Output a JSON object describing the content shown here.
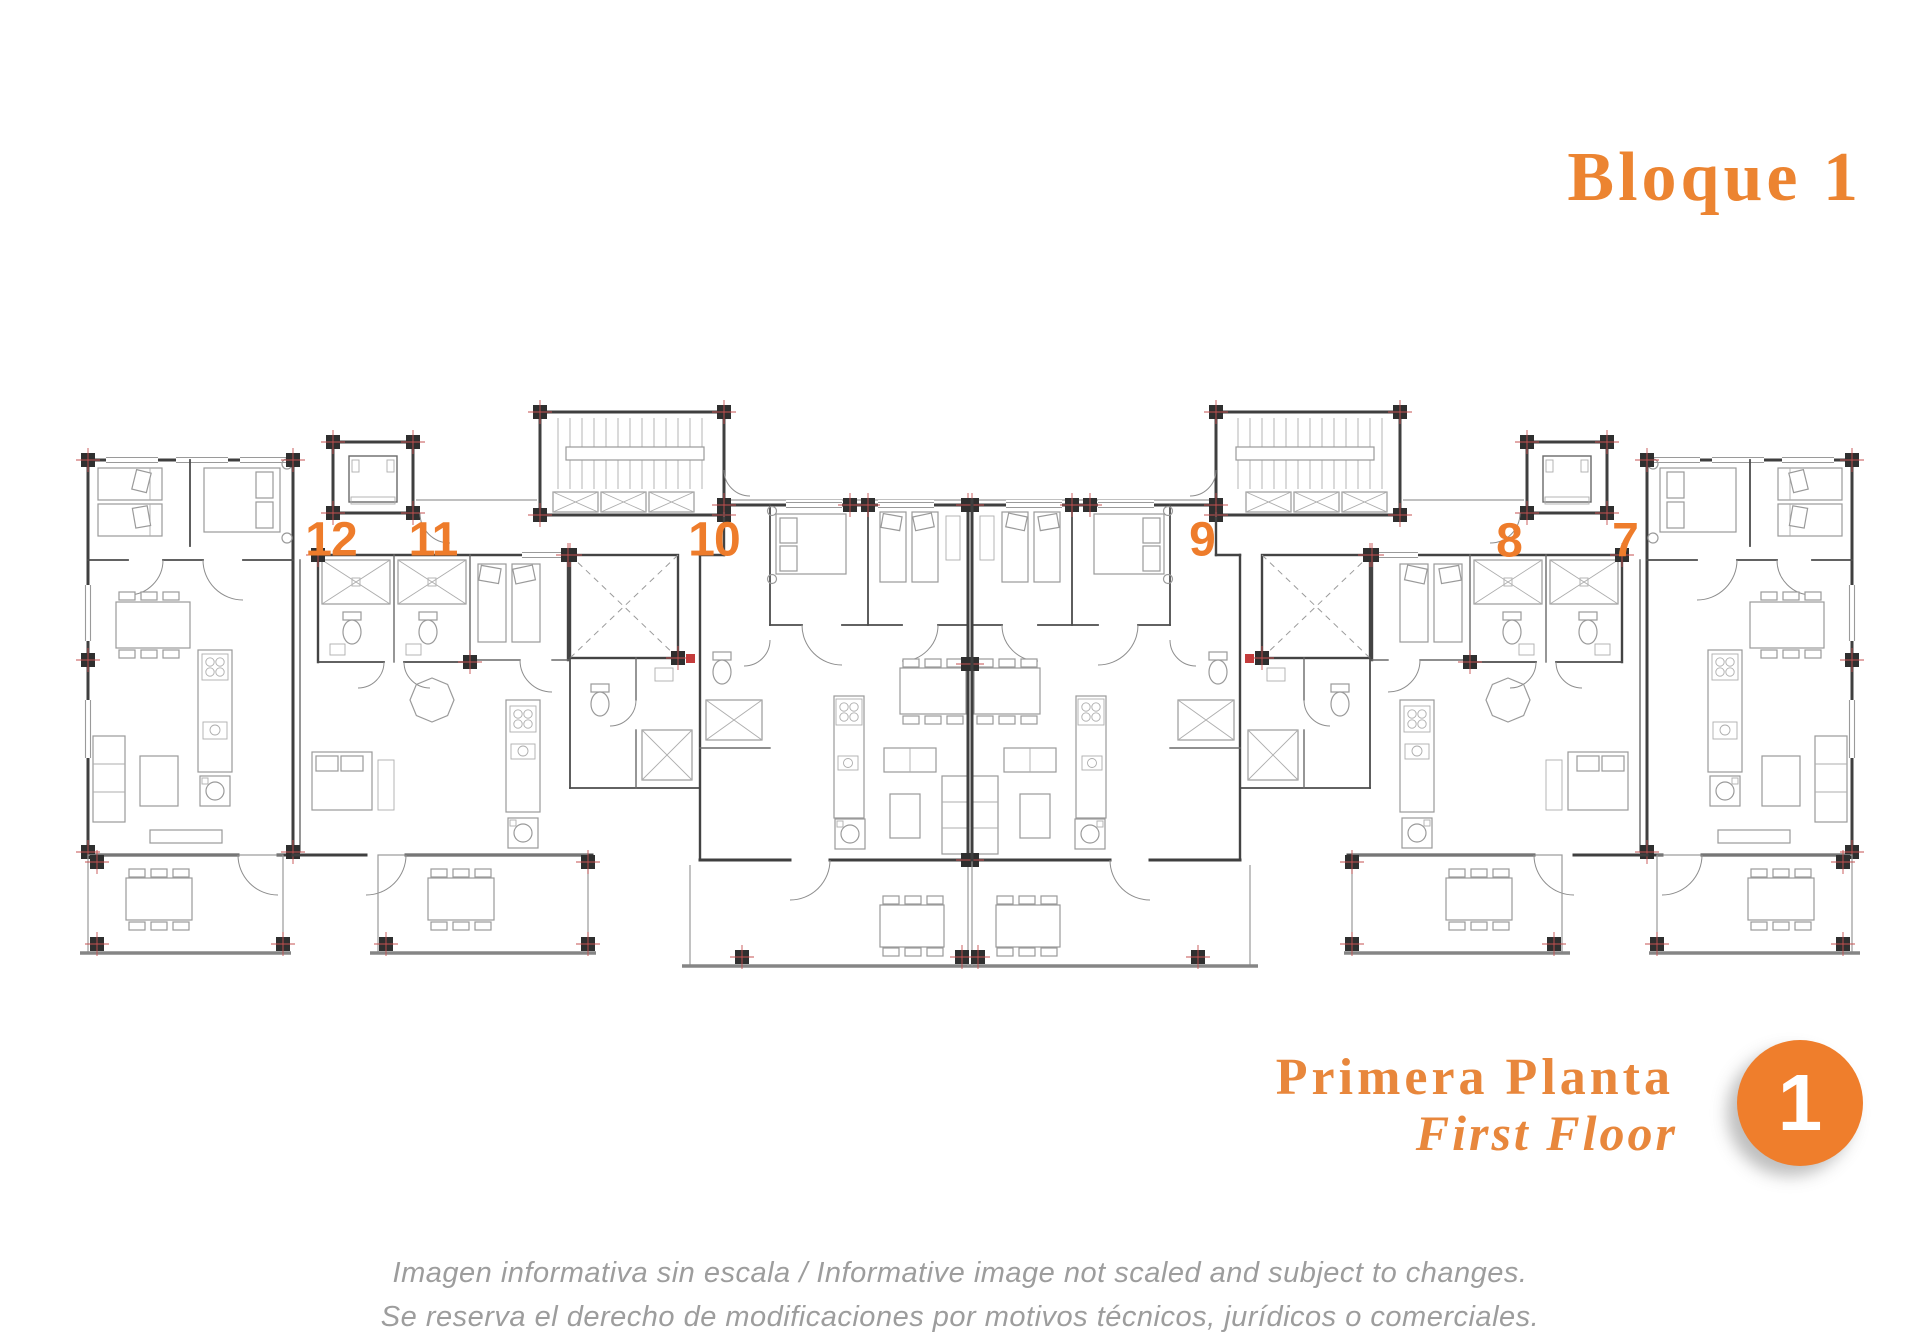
{
  "header": {
    "block_title": "Bloque 1"
  },
  "plan": {
    "units": [
      {
        "id": "unit-12",
        "number": "12"
      },
      {
        "id": "unit-11",
        "number": "11"
      },
      {
        "id": "unit-10",
        "number": "10"
      },
      {
        "id": "unit-9",
        "number": "9"
      },
      {
        "id": "unit-8",
        "number": "8"
      },
      {
        "id": "unit-7",
        "number": "7"
      }
    ]
  },
  "footer": {
    "floor_label_es": "Primera Planta",
    "floor_label_en": "First Floor",
    "floor_badge": "1"
  },
  "disclaimer": {
    "line1": "Imagen informativa sin escala /  Informative image not scaled and subject to changes.",
    "line2": "Se reserva el derecho de modificaciones por motivos técnicos, jurídicos o comerciales."
  },
  "colors": {
    "accent_orange": "#ED7D31",
    "plan_wall_gray": "#3F3F3F",
    "plan_light_gray": "#9A9A9A",
    "disclaimer_gray": "#9D9D9D",
    "marker_red": "#C65050"
  }
}
